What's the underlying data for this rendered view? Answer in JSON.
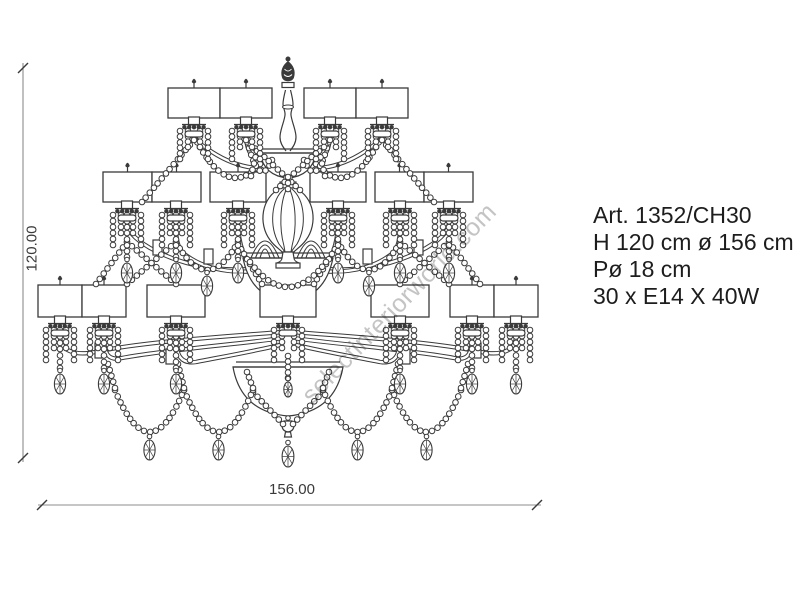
{
  "page": {
    "background": "#ffffff"
  },
  "dimensions": {
    "height_label": "120.00",
    "width_label": "156.00"
  },
  "specs": {
    "line1": "Art. 1352/CH30",
    "line2": "H 120 cm ø 156 cm",
    "line3": "Pø 18 cm",
    "line4": "30 x E14 X 40W"
  },
  "watermark": {
    "text": "selectinteriorworld.com"
  },
  "colors": {
    "line": "#3a3a3a",
    "dim_line": "#8c8c8c",
    "text": "#1d1d1d",
    "watermark": "#c4c4c4"
  }
}
